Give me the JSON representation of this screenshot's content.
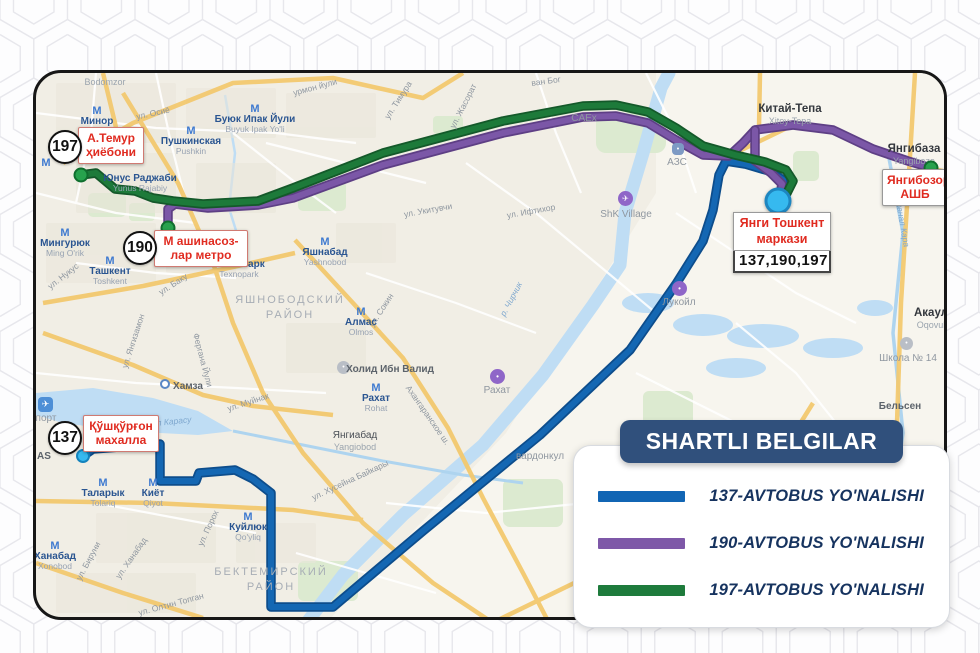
{
  "map": {
    "metro_icon": "М",
    "metro_stations": [
      {
        "name": "Минор",
        "latin": "Minor",
        "x": 61,
        "y": 33
      },
      {
        "name": "Пушкинская",
        "latin": "Pushkin",
        "x": 155,
        "y": 53
      },
      {
        "name": "Буюк Ипак Йули",
        "latin": "Buyuk Ipak Yo'li",
        "x": 219,
        "y": 31
      },
      {
        "name": "Юнус Раджаби",
        "latin": "Yunus Rajabiy",
        "x": 104,
        "y": 100,
        "cls": "noicon"
      },
      {
        "name": "Мингурюк",
        "latin": "Ming O'rik",
        "x": 29,
        "y": 155
      },
      {
        "name": "Ташкент",
        "latin": "Toshkent",
        "x": 74,
        "y": 183
      },
      {
        "name": "Технопарк",
        "latin": "Texnopark",
        "x": 203,
        "y": 176
      },
      {
        "name": "Яшнабад",
        "latin": "Yashnobod",
        "x": 289,
        "y": 164
      },
      {
        "name": "Алмас",
        "latin": "Olmos",
        "x": 325,
        "y": 234
      },
      {
        "name": "Рахат",
        "latin": "Rohat",
        "x": 340,
        "y": 310
      },
      {
        "name": "Таларык",
        "latin": "Tolariq",
        "x": 67,
        "y": 405
      },
      {
        "name": "Киёт",
        "latin": "Qiyot",
        "x": 117,
        "y": 405
      },
      {
        "name": "Куйлюк",
        "latin": "Qo'yliq",
        "x": 212,
        "y": 439
      },
      {
        "name": "Ханабад",
        "latin": "Xonobod",
        "x": 19,
        "y": 468
      }
    ],
    "places": [
      {
        "main": "Bodomzor",
        "x": 69,
        "y": 4,
        "cls": "graysm"
      },
      {
        "main": "Китай-Тепа",
        "sub": "Xitoy-Tepa",
        "x": 754,
        "y": 30,
        "cls": "big"
      },
      {
        "main": "Янгибаза",
        "sub": "Yangibozo",
        "x": 878,
        "y": 70,
        "cls": "big"
      },
      {
        "main": "Акаул",
        "sub": "Oqovul",
        "x": 895,
        "y": 234,
        "cls": "big"
      },
      {
        "main": "Школа № 14",
        "x": 872,
        "y": 280,
        "cls": "gray"
      },
      {
        "main": "Бельсен",
        "x": 864,
        "y": 328,
        "cls": "bold"
      },
      {
        "main": "Хамза",
        "x": 152,
        "y": 308,
        "cls": "bold"
      },
      {
        "main": "Янгиабад",
        "sub": "Yangiobod",
        "x": 319,
        "y": 357
      },
      {
        "main": "CAEx",
        "x": 548,
        "y": 40,
        "cls": "gray"
      },
      {
        "main": "ShK Village",
        "x": 590,
        "y": 136,
        "cls": "gray"
      },
      {
        "main": "АЗС",
        "x": 641,
        "y": 84,
        "cls": "gray"
      },
      {
        "main": "Холид Ибн Валид",
        "x": 354,
        "y": 291,
        "cls": "bold"
      },
      {
        "main": "Рахат",
        "x": 461,
        "y": 312,
        "cls": "gray"
      },
      {
        "main": "Лукойл",
        "x": 643,
        "y": 224,
        "cls": "gray"
      },
      {
        "main": "вардонкул",
        "x": 504,
        "y": 378,
        "cls": "gray"
      },
      {
        "main": "порт",
        "x": 10,
        "y": 340,
        "cls": "gray"
      },
      {
        "main": "AS",
        "x": 8,
        "y": 378,
        "cls": "bold"
      }
    ],
    "districts": [
      {
        "text": "ЯШНОБОДСКИЙ\nРАЙОН",
        "x": 254,
        "y": 220
      },
      {
        "text": "БЕКТЕМИРСКИЙ\nРАЙОН",
        "x": 235,
        "y": 492
      }
    ],
    "streets": [
      {
        "text": "ул. Осиё",
        "x": 117,
        "y": 40,
        "rot": -12
      },
      {
        "text": "урмон йули",
        "x": 279,
        "y": 14,
        "rot": -15
      },
      {
        "text": "ул. Тимура",
        "x": 362,
        "y": 27,
        "rot": -57
      },
      {
        "text": "ул. Жасорат",
        "x": 427,
        "y": 33,
        "rot": -63
      },
      {
        "text": "ван Бог",
        "x": 510,
        "y": 8,
        "rot": -8
      },
      {
        "text": "ул. Укитувчи",
        "x": 392,
        "y": 137,
        "rot": -10
      },
      {
        "text": "ул. Ифтихор",
        "x": 495,
        "y": 138,
        "rot": -10
      },
      {
        "text": "ул. Сокин",
        "x": 345,
        "y": 237,
        "rot": -57
      },
      {
        "text": "ул. Нукус",
        "x": 27,
        "y": 203,
        "rot": -38
      },
      {
        "text": "ул. Баку",
        "x": 137,
        "y": 211,
        "rot": -33
      },
      {
        "text": "ул. Янгизамон",
        "x": 97,
        "y": 268,
        "rot": -72
      },
      {
        "text": "Фергана Йули",
        "x": 167,
        "y": 287,
        "rot": 75
      },
      {
        "text": "ул. Муйнак",
        "x": 212,
        "y": 329,
        "rot": -18
      },
      {
        "text": "ул. Хусейна Байкары",
        "x": 314,
        "y": 407,
        "rot": -25
      },
      {
        "text": "канал Карасу",
        "x": 129,
        "y": 349,
        "rot": -6,
        "cls": "water"
      },
      {
        "text": "Ахангаранское ш.",
        "x": 392,
        "y": 342,
        "rot": 55
      },
      {
        "text": "ул. Порох",
        "x": 172,
        "y": 455,
        "rot": -65
      },
      {
        "text": "ул. Ханабад",
        "x": 95,
        "y": 485,
        "rot": -55
      },
      {
        "text": "ул. Бируни",
        "x": 52,
        "y": 488,
        "rot": -62
      },
      {
        "text": "ул. Олтин Топган",
        "x": 135,
        "y": 531,
        "rot": -15
      },
      {
        "text": "р. Чирчик",
        "x": 475,
        "y": 226,
        "rot": -62,
        "cls": "water"
      },
      {
        "text": "канал Кара",
        "x": 867,
        "y": 152,
        "rot": 80,
        "cls": "water"
      }
    ],
    "pois": [
      {
        "kind": "plane",
        "glyph": "✈",
        "x": 582,
        "y": 118
      },
      {
        "kind": "purple",
        "glyph": "•",
        "x": 636,
        "y": 208
      },
      {
        "kind": "purple",
        "glyph": "•",
        "x": 454,
        "y": 296
      },
      {
        "kind": "gray",
        "glyph": "•",
        "x": 301,
        "y": 288
      },
      {
        "kind": "gray",
        "glyph": "•",
        "x": 864,
        "y": 264
      },
      {
        "kind": "halt",
        "glyph": "",
        "x": 124,
        "y": 306
      },
      {
        "kind": "fuel",
        "glyph": "•",
        "x": 636,
        "y": 70
      },
      {
        "kind": "airport",
        "glyph": "✈",
        "x": 2,
        "y": 324
      },
      {
        "kind": "metro",
        "glyph": "М",
        "x": 10,
        "y": 84
      }
    ],
    "red_labels": [
      {
        "text": "А.Темур\nҳиёбони",
        "x": 42,
        "y": 54,
        "w": 66
      },
      {
        "text": "М ашинасоз-\nлар метро",
        "x": 118,
        "y": 157,
        "w": 94
      },
      {
        "text": "Қўшқўрғон\nмахалла",
        "x": 47,
        "y": 342,
        "w": 76
      },
      {
        "text": "Янгибозор\nАШБ",
        "x": 846,
        "y": 96,
        "w": 66,
        "cls": "gray"
      }
    ],
    "terminal": {
      "title": "Янги Тошкент\nмаркази",
      "numbers": "137,190,197",
      "x": 697,
      "y": 139,
      "w": 98
    },
    "route_badges": [
      {
        "number": "197",
        "x": 29,
        "y": 74
      },
      {
        "number": "190",
        "x": 104,
        "y": 175
      },
      {
        "number": "137",
        "x": 29,
        "y": 365
      }
    ],
    "dots": [
      {
        "type": "green",
        "x": 45,
        "y": 102
      },
      {
        "type": "green",
        "x": 132,
        "y": 155
      },
      {
        "type": "green",
        "x": 895,
        "y": 95
      },
      {
        "type": "cyan-small",
        "x": 47,
        "y": 383
      },
      {
        "type": "cyan-big",
        "x": 742,
        "y": 128
      }
    ],
    "routes": [
      {
        "id": "137",
        "color": "#1467b3",
        "casing": "#0d4d8c",
        "segments": [
          "47,383 57,376 124,371 124,408 160,408 163,400 199,397 217,406 235,420 235,534 297,534 387,458 504,362 594,277 640,211 667,168 677,137 683,102 690,88 709,91 733,98 747,107 749,119 742,127"
        ]
      },
      {
        "id": "190",
        "color": "#7b57a7",
        "casing": "#5e3f85",
        "segments": [
          "132,155 132,136 139,131 172,135 222,132 257,125 347,92 467,60 547,44 580,43 612,50 640,67 667,82 693,83 707,70 719,57 757,52 797,57 837,76 872,88 895,95",
          "719,57 719,88 735,100 746,111 744,122 742,127"
        ]
      },
      {
        "id": "197",
        "color": "#1d7a3a",
        "casing": "#14592a",
        "segments": [
          "45,102 60,100 79,116 99,118 117,125 137,128 167,131 222,128 257,115 347,80 467,48 547,33 580,32 612,39 640,55 667,73 699,82 729,89 750,97 757,108 751,120 742,127"
        ]
      }
    ]
  },
  "legend": {
    "title": "SHARTLI BELGILAR",
    "items": [
      {
        "label": "137-AVTOBUS YO'NALISHI",
        "color": "#1165b4"
      },
      {
        "label": "190-AVTOBUS YO'NALISHI",
        "color": "#7e58a8"
      },
      {
        "label": "197-AVTOBUS YO'NALISHI",
        "color": "#1e7b3c"
      }
    ]
  }
}
